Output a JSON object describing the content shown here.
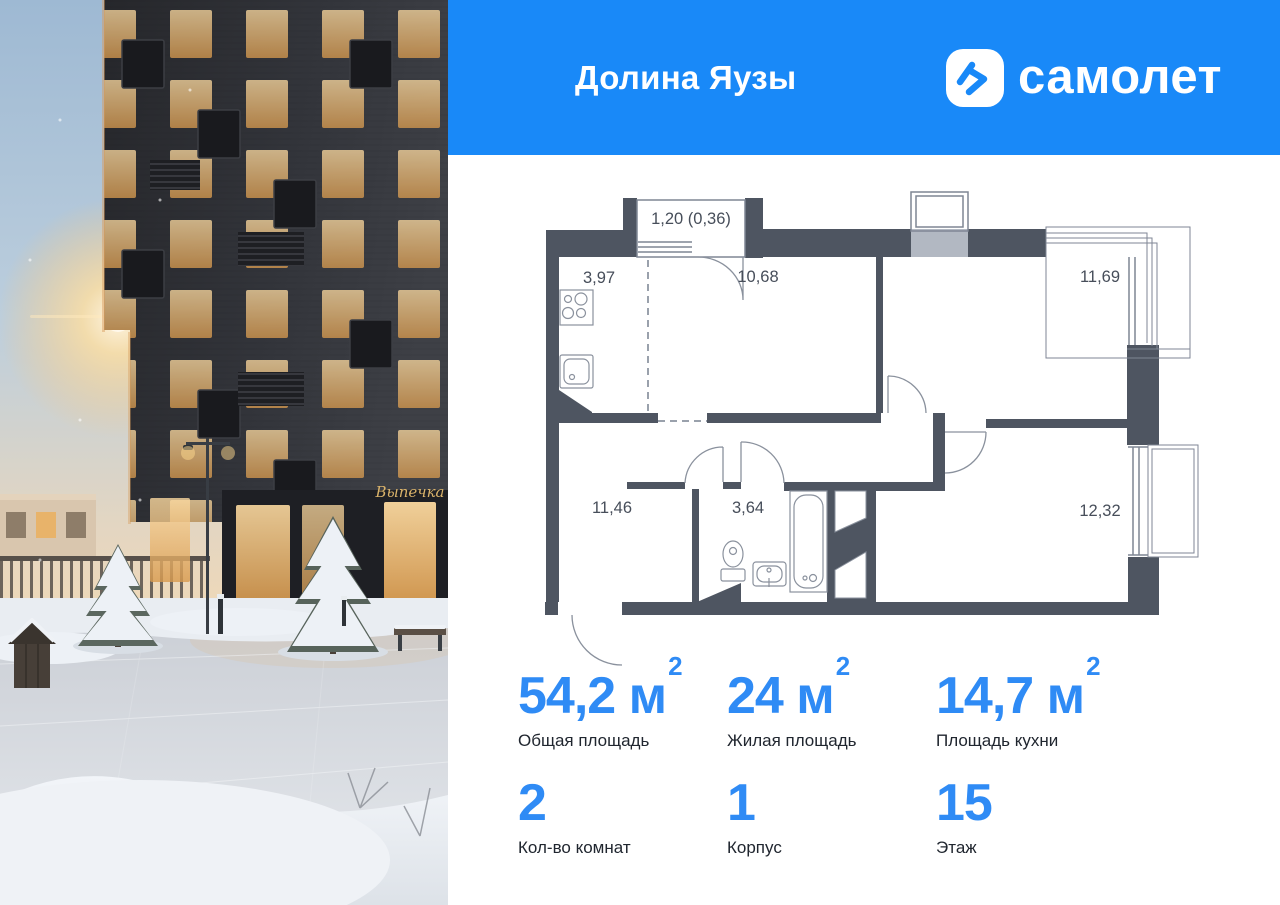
{
  "header": {
    "project_name": "Долина Яузы",
    "brand": "самолет",
    "bg_color": "#1989F8"
  },
  "photo": {
    "bakery_sign": "Выпечка"
  },
  "floor_plan": {
    "wall_color": "#4E5561",
    "balcony_label": "1,20 (0,36)",
    "rooms": [
      {
        "name": "kitchen",
        "area": "3,97"
      },
      {
        "name": "living",
        "area": "10,68"
      },
      {
        "name": "bedroom",
        "area": "11,69"
      },
      {
        "name": "hall-room",
        "area": "11,46"
      },
      {
        "name": "bathroom",
        "area": "3,64"
      },
      {
        "name": "bedroom-2",
        "area": "12,32"
      }
    ]
  },
  "stats": {
    "accent_color": "#2F8BF5",
    "row1": [
      {
        "value": "54,2",
        "unit": "м",
        "sup": "2",
        "label": "Общая площадь"
      },
      {
        "value": "24",
        "unit": "м",
        "sup": "2",
        "label": "Жилая площадь"
      },
      {
        "value": "14,7",
        "unit": "м",
        "sup": "2",
        "label": "Площадь кухни"
      }
    ],
    "row2": [
      {
        "value": "2",
        "label": "Кол-во комнат"
      },
      {
        "value": "1",
        "label": "Корпус"
      },
      {
        "value": "15",
        "label": "Этаж"
      }
    ]
  }
}
